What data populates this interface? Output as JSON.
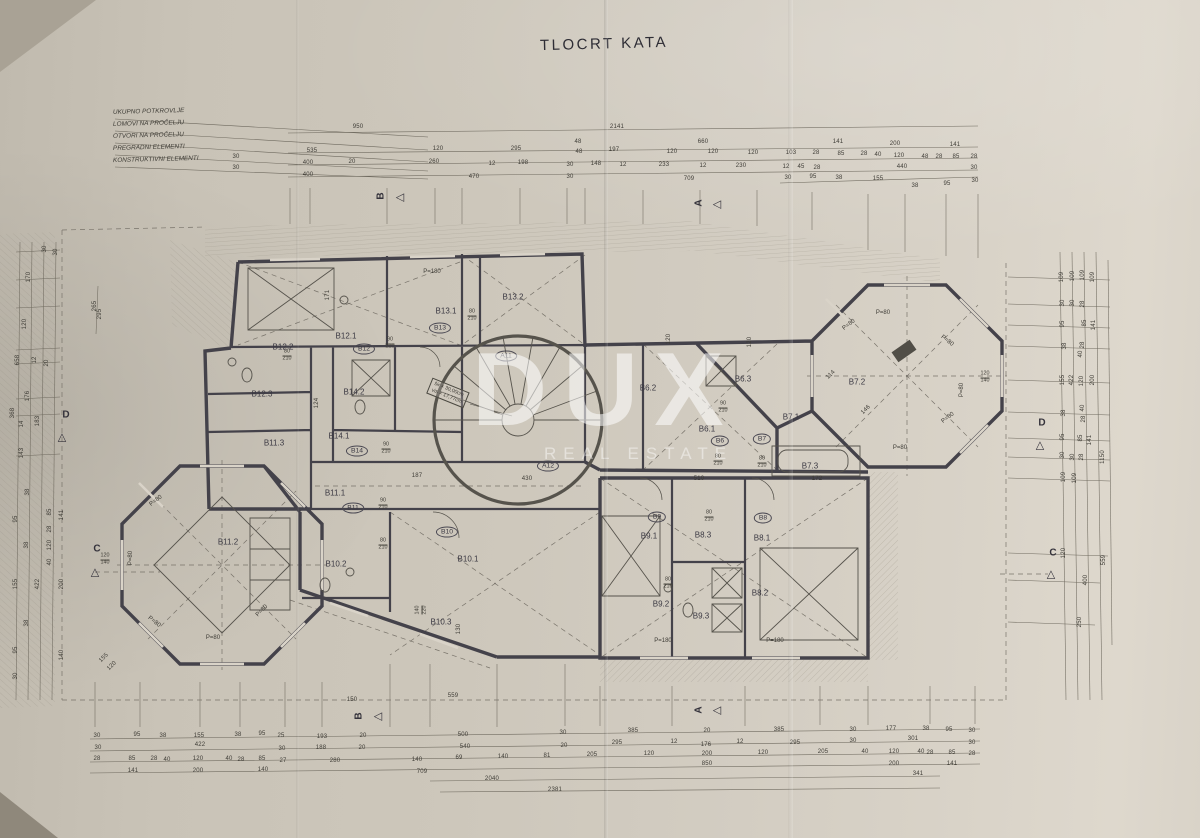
{
  "title": "TLOCRT KATA",
  "watermark": {
    "brand": "DUX",
    "subtitle": "REAL ESTATE"
  },
  "legend": [
    "UKUPNO POTKROVLJE",
    "LOMOVI NA PROČELJU",
    "OTVORI NA PROČELJU",
    "PREGRADNI ELEMENTI",
    "KONSTRUKTIVNI ELEMENTI"
  ],
  "stair_note": [
    "šir × 30,00cm",
    "vis × 17,77cm"
  ],
  "markers": [
    {
      "t": "B",
      "x": 381,
      "y": 196,
      "r": -90,
      "g": "◁",
      "gx": 400,
      "gy": 197
    },
    {
      "t": "A",
      "x": 699,
      "y": 203,
      "r": -90,
      "g": "◁",
      "gx": 717,
      "gy": 204
    },
    {
      "t": "B",
      "x": 359,
      "y": 716,
      "r": -90,
      "g": "◁",
      "gx": 378,
      "gy": 716
    },
    {
      "t": "A",
      "x": 699,
      "y": 710,
      "r": -90,
      "g": "◁",
      "gx": 717,
      "gy": 710
    },
    {
      "t": "C",
      "x": 97,
      "y": 549,
      "r": 0,
      "g": "△",
      "gx": 95,
      "gy": 572
    },
    {
      "t": "C",
      "x": 1053,
      "y": 553,
      "r": 0,
      "g": "△",
      "gx": 1051,
      "gy": 574
    },
    {
      "t": "D",
      "x": 66,
      "y": 415,
      "r": 0,
      "g": "△",
      "gx": 62,
      "gy": 437
    },
    {
      "t": "D",
      "x": 1042,
      "y": 423,
      "r": 0,
      "g": "△",
      "gx": 1040,
      "gy": 445
    }
  ],
  "rooms": [
    [
      "B12.2",
      283,
      347
    ],
    [
      "B12.1",
      346,
      336
    ],
    [
      "B12.3",
      262,
      394
    ],
    [
      "B14.2",
      354,
      392
    ],
    [
      "B14.1",
      339,
      436
    ],
    [
      "B11.3",
      274,
      443
    ],
    [
      "B13.2",
      513,
      297
    ],
    [
      "B13.1",
      446,
      311
    ],
    [
      "B11.1",
      335,
      493
    ],
    [
      "B11.2",
      228,
      542
    ],
    [
      "B10.2",
      336,
      564
    ],
    [
      "B10.1",
      468,
      559
    ],
    [
      "B10.3",
      441,
      622
    ],
    [
      "B6.3",
      743,
      379
    ],
    [
      "B6.2",
      648,
      388
    ],
    [
      "B6.1",
      707,
      429
    ],
    [
      "B7.1",
      791,
      417
    ],
    [
      "B7.2",
      857,
      382
    ],
    [
      "B7.3",
      810,
      466
    ],
    [
      "B9.1",
      649,
      536
    ],
    [
      "B9.2",
      661,
      604
    ],
    [
      "B9.3",
      701,
      616
    ],
    [
      "B8.1",
      762,
      538
    ],
    [
      "B8.3",
      703,
      535
    ],
    [
      "B8.2",
      760,
      593
    ]
  ],
  "ovals": [
    [
      "B12",
      364,
      349
    ],
    [
      "B14",
      357,
      451
    ],
    [
      "B13",
      440,
      328
    ],
    [
      "B11",
      353,
      508
    ],
    [
      "B10",
      447,
      532
    ],
    [
      "B6",
      720,
      441
    ],
    [
      "B7",
      762,
      439
    ],
    [
      "B9",
      657,
      517
    ],
    [
      "B8",
      763,
      518
    ],
    [
      "A11",
      506,
      356
    ],
    [
      "A12",
      548,
      466
    ]
  ],
  "plabels": [
    [
      "P=180",
      432,
      272
    ],
    [
      "P=180",
      663,
      641
    ],
    [
      "P=180",
      775,
      641
    ],
    [
      "P=80",
      156,
      501,
      -38
    ],
    [
      "P=80",
      131,
      558,
      -90
    ],
    [
      "P=80",
      154,
      622,
      38
    ],
    [
      "P=80",
      213,
      638
    ],
    [
      "P=80",
      262,
      611,
      -45
    ],
    [
      "P=80",
      883,
      313
    ],
    [
      "P=80",
      849,
      325,
      -38
    ],
    [
      "P=80",
      947,
      341,
      38
    ],
    [
      "P=80",
      962,
      390,
      -90
    ],
    [
      "P=80",
      948,
      418,
      -38
    ],
    [
      "P=80",
      900,
      448
    ]
  ],
  "fracs": [
    [
      "90/210",
      390,
      344
    ],
    [
      "80/210",
      472,
      316
    ],
    [
      "80/210",
      287,
      356
    ],
    [
      "90/210",
      386,
      449
    ],
    [
      "90/210",
      383,
      505
    ],
    [
      "80/210",
      383,
      545
    ],
    [
      "90/210",
      723,
      408
    ],
    [
      "80/210",
      718,
      461
    ],
    [
      "80/210",
      762,
      463
    ],
    [
      "80/210",
      709,
      517
    ],
    [
      "80/210",
      668,
      584
    ],
    [
      "120/140",
      105,
      560
    ],
    [
      "120/140",
      985,
      378
    ],
    [
      "140/220",
      422,
      610,
      -90
    ]
  ],
  "dims": [
    [
      "950",
      358,
      127
    ],
    [
      "2141",
      617,
      127
    ],
    [
      "48",
      578,
      142
    ],
    [
      "660",
      703,
      142
    ],
    [
      "141",
      838,
      142
    ],
    [
      "200",
      895,
      144
    ],
    [
      "141",
      955,
      145
    ],
    [
      "535",
      312,
      151
    ],
    [
      "120",
      438,
      149
    ],
    [
      "295",
      516,
      149
    ],
    [
      "48",
      579,
      152
    ],
    [
      "197",
      614,
      150
    ],
    [
      "120",
      672,
      152
    ],
    [
      "120",
      713,
      152
    ],
    [
      "120",
      753,
      153
    ],
    [
      "103",
      791,
      153
    ],
    [
      "28",
      816,
      153
    ],
    [
      "85",
      841,
      154
    ],
    [
      "28",
      864,
      154
    ],
    [
      "40",
      878,
      155
    ],
    [
      "120",
      899,
      156
    ],
    [
      "48",
      925,
      157
    ],
    [
      "28",
      939,
      157
    ],
    [
      "85",
      956,
      157
    ],
    [
      "28",
      974,
      157
    ],
    [
      "400",
      308,
      163
    ],
    [
      "20",
      352,
      162
    ],
    [
      "260",
      434,
      162
    ],
    [
      "12",
      492,
      164
    ],
    [
      "198",
      523,
      163
    ],
    [
      "30",
      570,
      165
    ],
    [
      "148",
      596,
      164
    ],
    [
      "12",
      623,
      165
    ],
    [
      "233",
      664,
      165
    ],
    [
      "12",
      703,
      166
    ],
    [
      "230",
      741,
      166
    ],
    [
      "12",
      786,
      167
    ],
    [
      "45",
      801,
      167
    ],
    [
      "28",
      817,
      168
    ],
    [
      "440",
      902,
      167
    ],
    [
      "30",
      974,
      168
    ],
    [
      "400",
      308,
      175
    ],
    [
      "470",
      474,
      177
    ],
    [
      "30",
      570,
      177
    ],
    [
      "709",
      689,
      179
    ],
    [
      "30",
      788,
      178
    ],
    [
      "95",
      813,
      177
    ],
    [
      "38",
      839,
      178
    ],
    [
      "155",
      878,
      179
    ],
    [
      "38",
      915,
      186
    ],
    [
      "95",
      947,
      184
    ],
    [
      "30",
      975,
      181
    ],
    [
      "30",
      236,
      157
    ],
    [
      "30",
      236,
      168
    ],
    [
      "30",
      45,
      249,
      -90
    ],
    [
      "30",
      56,
      252,
      -90
    ],
    [
      "170",
      29,
      277,
      -90
    ],
    [
      "120",
      25,
      324,
      -90
    ],
    [
      "265",
      95,
      306,
      -90
    ],
    [
      "295",
      100,
      314,
      -90
    ],
    [
      "658",
      18,
      360,
      -90
    ],
    [
      "12",
      35,
      360,
      -90
    ],
    [
      "20",
      47,
      363,
      -90
    ],
    [
      "176",
      28,
      396,
      -90
    ],
    [
      "368",
      13,
      413,
      -90
    ],
    [
      "183",
      38,
      421,
      -90
    ],
    [
      "14",
      22,
      424,
      -90
    ],
    [
      "143",
      22,
      453,
      -90
    ],
    [
      "38",
      28,
      492,
      -90
    ],
    [
      "95",
      16,
      519,
      -90
    ],
    [
      "85",
      50,
      512,
      -90
    ],
    [
      "141",
      62,
      515,
      -90
    ],
    [
      "28",
      50,
      529,
      -90
    ],
    [
      "38",
      27,
      545,
      -90
    ],
    [
      "120",
      50,
      545,
      -90
    ],
    [
      "40",
      50,
      562,
      -90
    ],
    [
      "155",
      16,
      584,
      -90
    ],
    [
      "422",
      38,
      584,
      -90
    ],
    [
      "200",
      62,
      584,
      -90
    ],
    [
      "38",
      27,
      623,
      -90
    ],
    [
      "95",
      16,
      650,
      -90
    ],
    [
      "140",
      62,
      655,
      -90
    ],
    [
      "30",
      16,
      676,
      -90
    ],
    [
      "155",
      104,
      658,
      -45
    ],
    [
      "120",
      112,
      666,
      -45
    ],
    [
      "109",
      1062,
      277,
      -90
    ],
    [
      "109",
      1073,
      276,
      -90
    ],
    [
      "109",
      1083,
      275,
      -90
    ],
    [
      "109",
      1093,
      277,
      -90
    ],
    [
      "30",
      1063,
      303,
      -90
    ],
    [
      "30",
      1073,
      303,
      -90
    ],
    [
      "28",
      1083,
      304,
      -90
    ],
    [
      "95",
      1063,
      324,
      -90
    ],
    [
      "85",
      1085,
      323,
      -90
    ],
    [
      "141",
      1094,
      325,
      -90
    ],
    [
      "38",
      1065,
      346,
      -90
    ],
    [
      "28",
      1083,
      345,
      -90
    ],
    [
      "40",
      1081,
      354,
      -90
    ],
    [
      "155",
      1063,
      380,
      -90
    ],
    [
      "422",
      1072,
      380,
      -90
    ],
    [
      "120",
      1082,
      381,
      -90
    ],
    [
      "200",
      1093,
      380,
      -90
    ],
    [
      "38",
      1064,
      413,
      -90
    ],
    [
      "40",
      1083,
      408,
      -90
    ],
    [
      "28",
      1084,
      419,
      -90
    ],
    [
      "95",
      1063,
      437,
      -90
    ],
    [
      "85",
      1081,
      438,
      -90
    ],
    [
      "141",
      1090,
      440,
      -90
    ],
    [
      "30",
      1063,
      455,
      -90
    ],
    [
      "30",
      1073,
      457,
      -90
    ],
    [
      "28",
      1082,
      457,
      -90
    ],
    [
      "109",
      1064,
      477,
      -90
    ],
    [
      "109",
      1075,
      478,
      -90
    ],
    [
      "1150",
      1103,
      457,
      -90
    ],
    [
      "120",
      1064,
      553,
      -90
    ],
    [
      "559",
      1104,
      560,
      -90
    ],
    [
      "400",
      1086,
      580,
      -90
    ],
    [
      "250",
      1080,
      622,
      -90
    ],
    [
      "30",
      97,
      736
    ],
    [
      "95",
      137,
      735
    ],
    [
      "38",
      163,
      736
    ],
    [
      "155",
      199,
      736
    ],
    [
      "38",
      238,
      735
    ],
    [
      "95",
      262,
      734
    ],
    [
      "25",
      281,
      736
    ],
    [
      "193",
      322,
      737
    ],
    [
      "20",
      363,
      736
    ],
    [
      "30",
      98,
      748
    ],
    [
      "422",
      200,
      745
    ],
    [
      "30",
      282,
      749
    ],
    [
      "188",
      321,
      748
    ],
    [
      "20",
      362,
      748
    ],
    [
      "28",
      97,
      759
    ],
    [
      "85",
      132,
      759
    ],
    [
      "28",
      154,
      759
    ],
    [
      "40",
      167,
      760
    ],
    [
      "120",
      198,
      759
    ],
    [
      "40",
      229,
      759
    ],
    [
      "28",
      241,
      760
    ],
    [
      "85",
      262,
      759
    ],
    [
      "27",
      283,
      761
    ],
    [
      "280",
      335,
      761
    ],
    [
      "140",
      417,
      760
    ],
    [
      "141",
      133,
      771
    ],
    [
      "200",
      198,
      771
    ],
    [
      "140",
      263,
      770
    ],
    [
      "709",
      422,
      772
    ],
    [
      "150",
      352,
      700
    ],
    [
      "559",
      453,
      696
    ],
    [
      "500",
      463,
      735
    ],
    [
      "30",
      563,
      733
    ],
    [
      "385",
      633,
      731
    ],
    [
      "20",
      707,
      731
    ],
    [
      "385",
      779,
      730
    ],
    [
      "30",
      853,
      730
    ],
    [
      "177",
      891,
      729
    ],
    [
      "38",
      926,
      729
    ],
    [
      "95",
      949,
      730
    ],
    [
      "30",
      972,
      731
    ],
    [
      "540",
      465,
      747
    ],
    [
      "20",
      564,
      746
    ],
    [
      "295",
      617,
      743
    ],
    [
      "12",
      674,
      742
    ],
    [
      "176",
      706,
      745
    ],
    [
      "12",
      740,
      742
    ],
    [
      "295",
      795,
      743
    ],
    [
      "30",
      853,
      741
    ],
    [
      "301",
      913,
      739
    ],
    [
      "30",
      972,
      743
    ],
    [
      "69",
      459,
      758
    ],
    [
      "140",
      503,
      757
    ],
    [
      "81",
      547,
      756
    ],
    [
      "205",
      592,
      755
    ],
    [
      "120",
      649,
      754
    ],
    [
      "200",
      707,
      754
    ],
    [
      "120",
      763,
      753
    ],
    [
      "205",
      823,
      752
    ],
    [
      "40",
      865,
      752
    ],
    [
      "120",
      894,
      752
    ],
    [
      "40",
      921,
      752
    ],
    [
      "28",
      930,
      753
    ],
    [
      "85",
      952,
      753
    ],
    [
      "28",
      972,
      754
    ],
    [
      "850",
      707,
      764
    ],
    [
      "200",
      894,
      764
    ],
    [
      "141",
      952,
      764
    ],
    [
      "2040",
      492,
      779
    ],
    [
      "2381",
      555,
      790
    ],
    [
      "341",
      918,
      774
    ],
    [
      "171",
      328,
      295,
      -90
    ],
    [
      "124",
      317,
      403,
      -90
    ],
    [
      "187",
      417,
      476
    ],
    [
      "430",
      527,
      479
    ],
    [
      "510",
      699,
      479
    ],
    [
      "172",
      817,
      479
    ],
    [
      "114",
      831,
      375,
      -45
    ],
    [
      "146",
      866,
      410,
      -45
    ],
    [
      "120",
      669,
      339,
      -90
    ],
    [
      "120",
      750,
      342,
      -90
    ],
    [
      "130",
      459,
      629,
      -90
    ]
  ]
}
